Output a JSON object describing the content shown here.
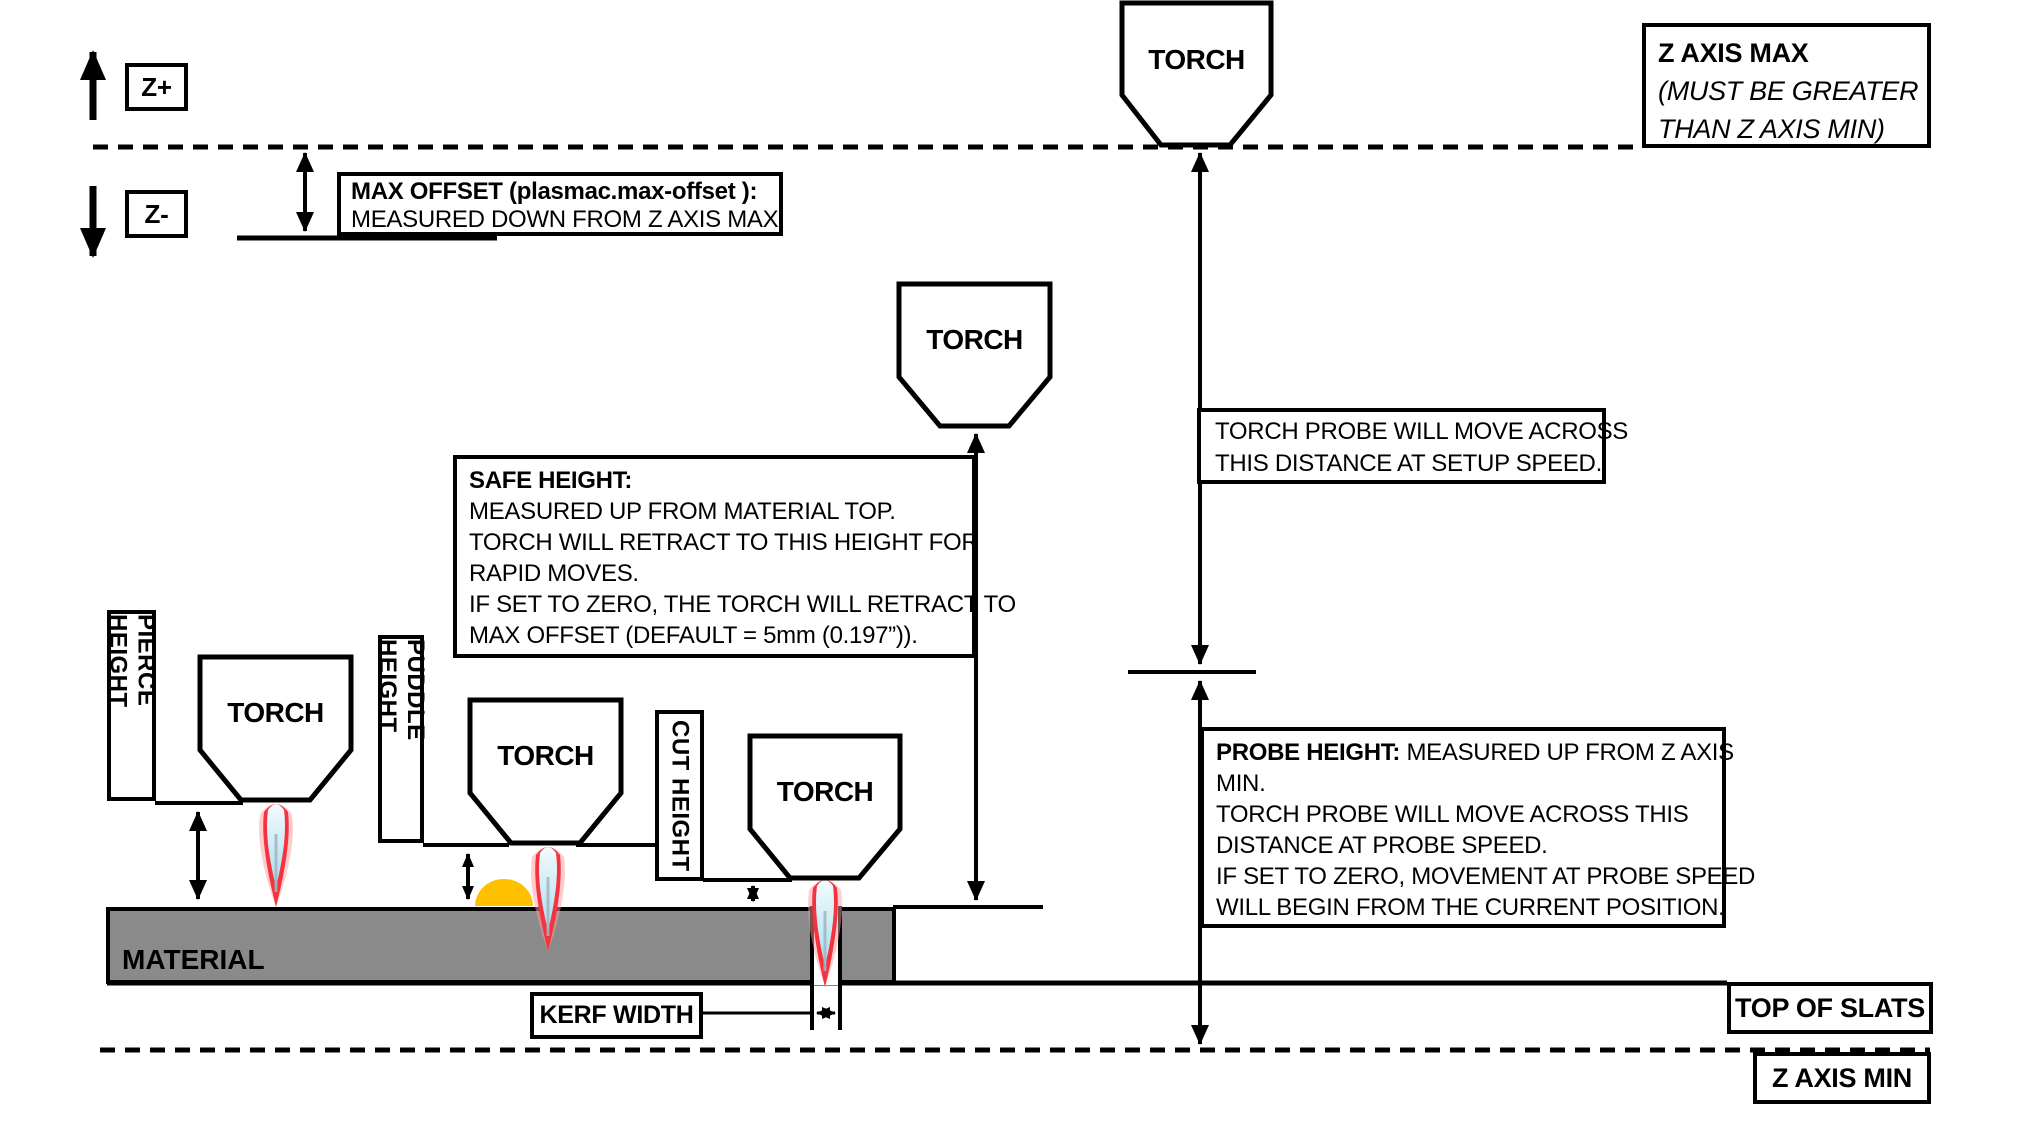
{
  "labels": {
    "z_plus": "Z+",
    "z_minus": "Z-",
    "torch": "TORCH",
    "material": "MATERIAL",
    "kerf_width": "KERF WIDTH",
    "top_of_slats": "TOP OF SLATS",
    "z_axis_min": "Z AXIS MIN",
    "pierce_height": "PIERCE HEIGHT",
    "puddle_height": "PUDDLE HEIGHT",
    "cut_height": "CUT HEIGHT"
  },
  "boxes": {
    "z_axis_max": {
      "line1": "Z AXIS MAX",
      "line2": "(MUST BE GREATER",
      "line3": "THAN Z AXIS MIN)"
    },
    "max_offset": {
      "line1": "MAX OFFSET (plasmac.max-offset ):",
      "line2": "MEASURED DOWN FROM Z AXIS MAX"
    },
    "safe_height": {
      "title": "SAFE HEIGHT:",
      "lines": [
        "MEASURED UP FROM MATERIAL TOP.",
        "TORCH WILL RETRACT TO THIS HEIGHT FOR",
        "RAPID MOVES.",
        "IF SET TO ZERO, THE TORCH WILL RETRACT TO",
        "MAX OFFSET (DEFAULT = 5mm (0.197”))."
      ]
    },
    "torch_probe_setup": {
      "line1": "TORCH PROBE WILL MOVE ACROSS",
      "line2": "THIS DISTANCE AT SETUP SPEED."
    },
    "probe_height": {
      "title": "PROBE HEIGHT:",
      "title_rest": " MEASURED UP FROM Z AXIS",
      "lines": [
        "MIN.",
        "TORCH PROBE WILL MOVE ACROSS THIS",
        "DISTANCE AT PROBE SPEED.",
        "IF SET TO ZERO,  MOVEMENT AT PROBE SPEED",
        "WILL BEGIN FROM THE CURRENT POSITION."
      ]
    }
  },
  "colors": {
    "ink": "#000000",
    "material_gray": "#8a8a8a",
    "puddle_yellow": "#ffc000",
    "flame_red": "#f5333f",
    "flame_halo_pink": "#ff9b9b",
    "flame_blue_light": "#f2fbfd",
    "flame_blue_dark": "#a9dcee",
    "flame_core_gray": "#9fb6c0"
  }
}
